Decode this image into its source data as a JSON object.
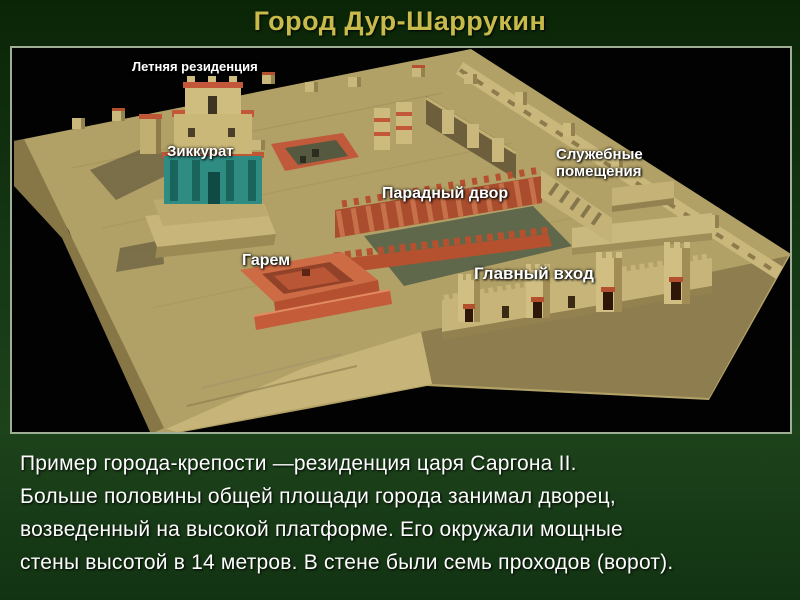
{
  "slide": {
    "title": "Город Дур-Шаррукин",
    "body_lines": [
      "Пример города-крепости —резиденция царя Саргона II.",
      "Больше половины общей площади города занимал дворец,",
      "возведенный на высокой платформе. Его окружали мощные",
      "стены высотой в 14 метров. В стене были семь проходов (ворот)."
    ]
  },
  "illustration": {
    "labels": [
      {
        "text": "Летняя резиденция"
      },
      {
        "text": "Зиккурат"
      },
      {
        "text": "Служебные помещения"
      },
      {
        "text": "Парадный двор"
      },
      {
        "text": "Гарем"
      },
      {
        "text": "Главный вход"
      }
    ]
  },
  "colors": {
    "slide_background_top": "#0a2506",
    "slide_background_bottom": "#1d431b",
    "title_text": "#c9ba4c",
    "body_text": "#fdfdfd",
    "label_text": "#ffffff",
    "image_border": "#9fae94",
    "image_background": "#000000",
    "platform_tan": "#b2a166",
    "terracotta_red": "#c05a3a",
    "ziggurat_teal": "#2e8c83",
    "courtyard_floor": "#5f684b"
  }
}
